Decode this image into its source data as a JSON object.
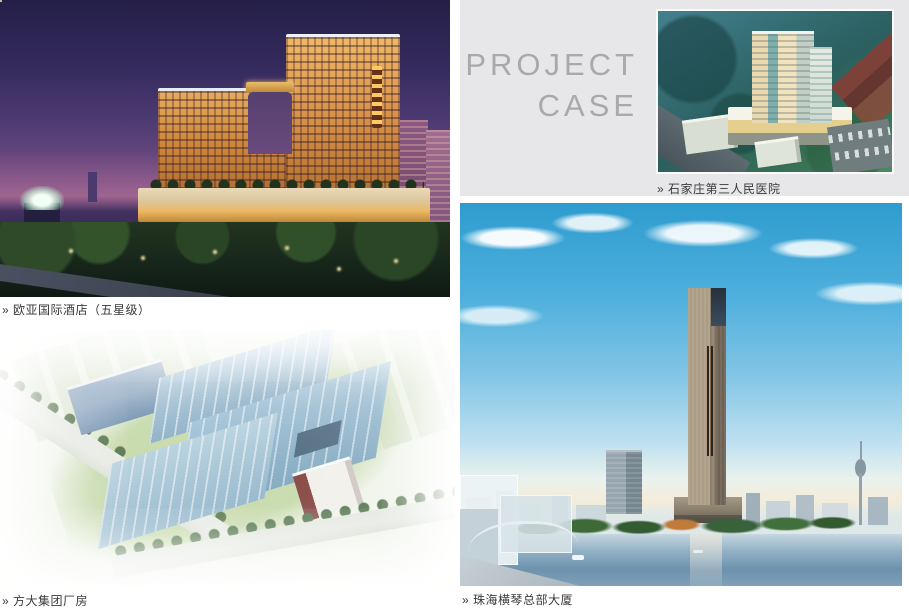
{
  "colors": {
    "page_bg": "#ffffff",
    "panel_bg": "#e7e6e8",
    "title_text": "#a9a9ad",
    "caption_text": "#3a3a3a"
  },
  "title_block": {
    "line1": "PROJECT",
    "line2": "CASE"
  },
  "cases": [
    {
      "id": "hotel",
      "caption": "» 欧亚国际酒店（五星级）"
    },
    {
      "id": "factory",
      "caption": "» 方大集团厂房"
    },
    {
      "id": "hospital",
      "caption": "» 石家庄第三人民医院"
    },
    {
      "id": "tower",
      "caption": "» 珠海横琴总部大厦"
    }
  ]
}
